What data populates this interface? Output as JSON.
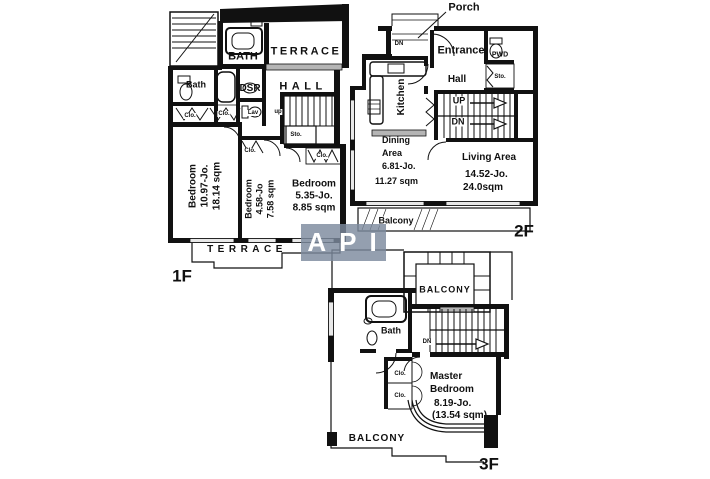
{
  "watermark": {
    "text": "API"
  },
  "floor1f": {
    "floor_label": "1F",
    "bath_upper": "BATH",
    "terrace_upper": "TERRACE",
    "bath_left": "Bath",
    "dsr": "DSR",
    "hall": "HALL",
    "lav": "Lav",
    "up": "up",
    "sto": "Sto.",
    "clo_a": "Clo.",
    "clo_b": "Clo.",
    "clo_bed2": "Clo.",
    "clo_bed3": "Clo.",
    "bedroom1_name": "Bedroom",
    "bedroom1_jo": "10.97-Jo.",
    "bedroom1_sqm": "18.14 sqm",
    "bedroom2_name": "Bedroom",
    "bedroom2_jo": "4.58-Jo",
    "bedroom2_sqm": "7.58 sqm",
    "bedroom3_name": "Bedroom",
    "bedroom3_jo": "5.35-Jo.",
    "bedroom3_sqm": "8.85 sqm",
    "terrace_lower": "TERRACE"
  },
  "floor2f": {
    "floor_label": "2F",
    "porch": "Porch",
    "porch_dn": "DN",
    "entrance": "Entrance",
    "pwd": "PWD",
    "hall": "Hall",
    "sto": "Sto.",
    "kitchen": "Kitchen",
    "up": "UP",
    "dn": "DN",
    "dining_line1": "Dining",
    "dining_line2": "Area",
    "dining_jo": "6.81-Jo.",
    "dining_sqm": "11.27 sqm",
    "living_name": "Living Area",
    "living_jo": "14.52-Jo.",
    "living_sqm": "24.0sqm",
    "balcony": "Balcony"
  },
  "floor3f": {
    "floor_label": "3F",
    "balcony_upper": "BALCONY",
    "bath": "Bath",
    "dn": "DN",
    "clo_a": "Clo.",
    "clo_b": "Clo.",
    "master_line1": "Master",
    "master_line2": "Bedroom",
    "master_jo": "8.19-Jo.",
    "master_sqm": "(13.54 sqm)",
    "balcony_lower": "BALCONY"
  }
}
